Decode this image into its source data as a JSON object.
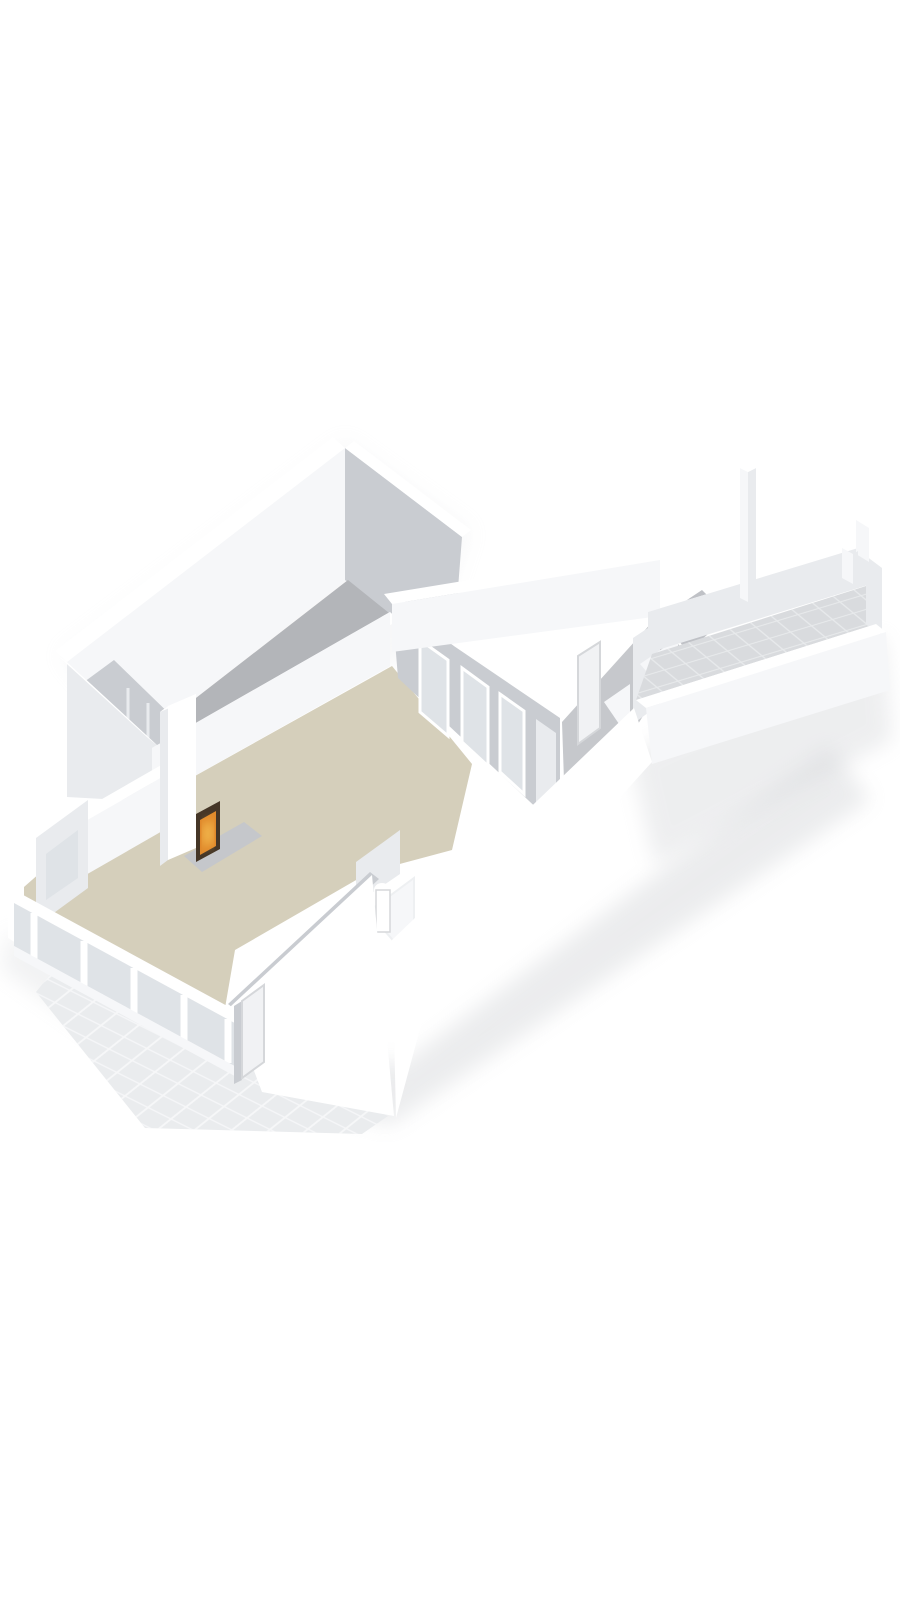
{
  "scene": {
    "type": "3d-floorplan-render",
    "style": "isometric-dollhouse-cutaway",
    "storey": "ground-floor",
    "background": "#ffffff",
    "rooms": [
      {
        "id": "garage",
        "floor": "concrete-gray",
        "color_key": "floor_garage"
      },
      {
        "id": "living-room",
        "floor": "beige",
        "color_key": "floor_living"
      },
      {
        "id": "hall",
        "floor": "gray",
        "color_key": "floor_hall"
      },
      {
        "id": "storage-room",
        "floor": "gray",
        "color_key": "floor_utility"
      },
      {
        "id": "toilet",
        "floor": "beige",
        "color_key": "floor_living"
      },
      {
        "id": "terrace",
        "floor": "tiled",
        "color_key": "tile_terrace"
      },
      {
        "id": "patio",
        "floor": "tiled",
        "color_key": "tile_patio"
      }
    ],
    "fixtures": [
      "fireplace-with-fire",
      "sunroom-glazing-band",
      "window-wall-three-windows",
      "front-door",
      "interior-door",
      "toilet-fixture",
      "terrace-pillar",
      "terrace-post"
    ]
  },
  "colors": {
    "background": "#ffffff",
    "wall_top": "#ffffff",
    "wall_lit": "#f6f7f9",
    "wall_side": "#e9ebee",
    "wall_shade": "#c9ccd1",
    "wall_deep": "#b9bcc1",
    "floor_garage": "#b3b5b9",
    "floor_living": "#d5cfbb",
    "floor_hall": "#c6c8cc",
    "floor_utility": "#bfc1c6",
    "tile_terrace": "#d9dbde",
    "tile_grid": "#e8eaec",
    "tile_patio": "#eaecee",
    "patio_grid": "#f7f8f9",
    "glass": "#dfe3e7",
    "door": "#f1f2f4",
    "door_edge": "#d5d7da",
    "hearth": "#c5c7cb",
    "fire_dark": "#453627",
    "fire_glow": "#e0892b",
    "fire_bright": "#f8c659",
    "shadow": "#d4d6d9",
    "edge_light": "#eef0f2"
  }
}
